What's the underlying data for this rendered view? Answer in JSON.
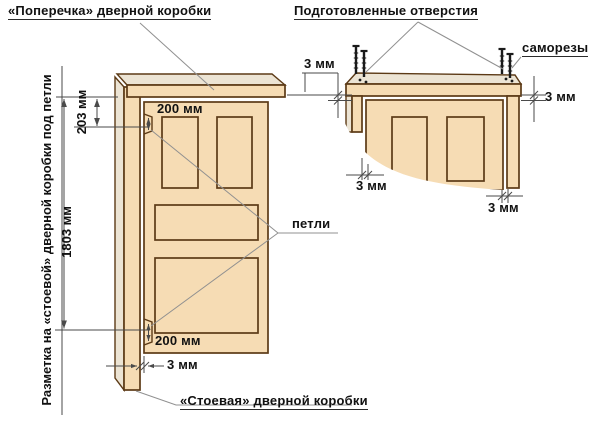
{
  "titles": {
    "frame_header": "«Поперечка» дверной коробки",
    "prepared_holes": "Подготовленные отверстия"
  },
  "labels": {
    "screws": "саморезы",
    "hinges": "петли",
    "frame_post": "«Стоевая» дверной коробки",
    "side_note": "Разметка на «стоевой» дверной коробки под петли"
  },
  "dims": {
    "header_to_hinge": "203 мм",
    "between_hinges": "1803 мм",
    "top_hinge_offset": "200 мм",
    "bottom_hinge_offset": "200 мм",
    "gap_main_bottom": "3 мм",
    "gap_detail_top_left": "3 мм",
    "gap_detail_top_right": "3 мм",
    "gap_detail_bottom_left": "3 мм",
    "gap_detail_bottom_right": "3 мм"
  },
  "colors": {
    "wood": "#F6DCB4",
    "wood_light": "#ECE4D4",
    "outline": "#5C3A16",
    "dim": "#4A4A4A",
    "leader": "#909090",
    "ink": "#111111",
    "screw": "#1A1A1A",
    "bg": "#FFFFFF"
  }
}
